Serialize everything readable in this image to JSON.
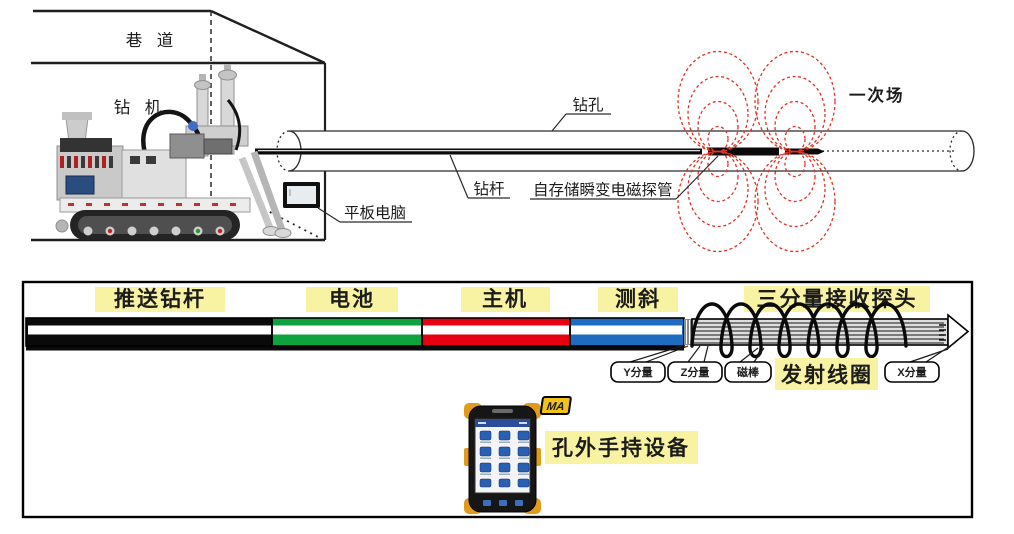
{
  "top": {
    "roadway": "巷 道",
    "drill_rig": "钻 机",
    "borehole": "钻孔",
    "drill_rod": "钻杆",
    "probe": "自存储瞬变电磁探管",
    "tablet": "平板电脑",
    "primary_field": "一次场",
    "field_red": "#e03224"
  },
  "bottom": {
    "segments": [
      {
        "label": "推送钻杆",
        "color": "#0a0a0a"
      },
      {
        "label": "电池",
        "color": "#0fa340"
      },
      {
        "label": "主机",
        "color": "#e60012"
      },
      {
        "label": "测斜",
        "color": "#1e6cc0"
      }
    ],
    "receiver_probe": "三分量接收探头",
    "transmit_coil": "发射线圈",
    "component_y": "Y分量",
    "component_z": "Z分量",
    "magnetic_rod": "磁棒",
    "component_x": "X分量",
    "handheld_device": "孔外手持设备",
    "ma_badge": "MA",
    "highlight_yellow": "#f8f3a2"
  }
}
